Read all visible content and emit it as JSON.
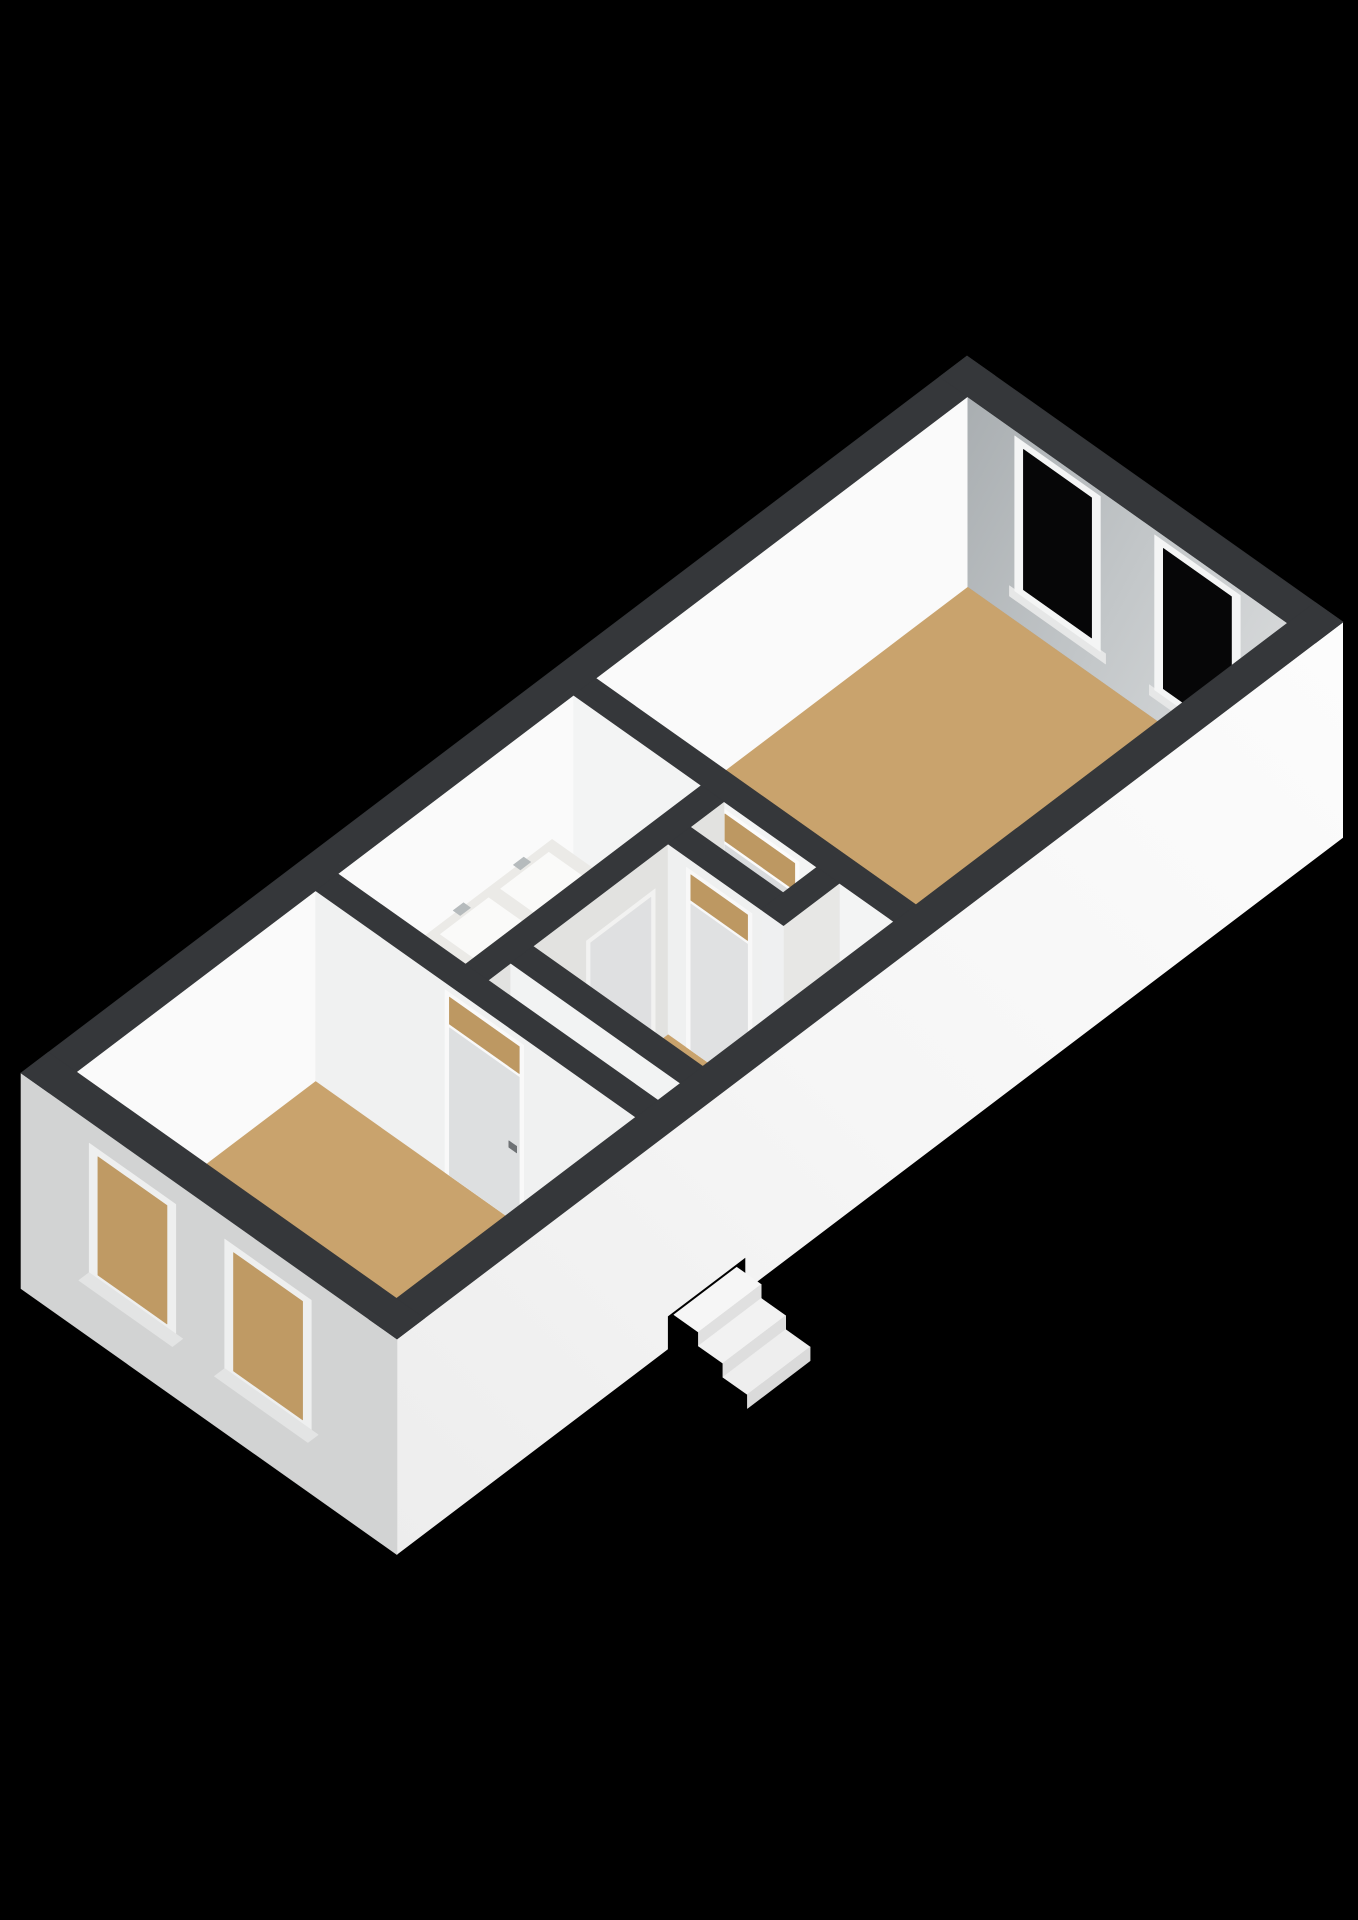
{
  "meta": {
    "kind": "3d-floorplan-render",
    "background": "#000000",
    "wall_top_color": "#35373a",
    "floor_color": "#c9a36d",
    "bathroom_floor_color": "#e9e8e5",
    "exterior_wall_color": "#f5f5f5",
    "glass_dark_color": "#060607",
    "glass_tan_color": "#bf9a64"
  },
  "scene": {
    "canvas": {
      "w": 1358,
      "h": 1920,
      "bg": "#000000"
    },
    "projection": {
      "origin": [
        21,
        1073
      ],
      "U": [
        86.0,
        -65.18
      ],
      "V": [
        87.44,
        61.86
      ],
      "zScale": 73.1,
      "wallTop": 2.6
    },
    "shapes": [
      {
        "name": "floor-bedroom",
        "t": "plan",
        "fill": "#c9a36d",
        "u1": 0.32,
        "v1": 0.32,
        "u2": 3.1,
        "v2": 3.98,
        "z": 0
      },
      {
        "name": "floor-bathroom",
        "t": "plan",
        "fill": "#e9e8e5",
        "u1": 3.36,
        "v1": 0.32,
        "u2": 6.1,
        "v2": 1.78,
        "z": 0
      },
      {
        "name": "floor-hall",
        "t": "plan",
        "fill": "#c9a36d",
        "u1": 3.36,
        "v1": 2.04,
        "u2": 6.1,
        "v2": 3.98,
        "z": 0
      },
      {
        "name": "floor-toilet",
        "t": "plan",
        "fill": "#edecea",
        "u1": 5.71,
        "v1": 2.04,
        "u2": 6.1,
        "v2": 3.1,
        "z": 0
      },
      {
        "name": "floor-living-room",
        "t": "plan",
        "fill": "#c9a36d",
        "u1": 6.36,
        "v1": 0.32,
        "u2": 10.68,
        "v2": 3.98,
        "z": 0
      },
      {
        "name": "wall-nw-interior-face",
        "t": "v",
        "fill": "#fafafa",
        "v": 0.32,
        "u1": 0.32,
        "u2": 10.68,
        "z1": 0,
        "z2": 2.6
      },
      {
        "name": "wall-ne-interior-face",
        "t": "u",
        "fill": "url(#gNE)",
        "u": 10.68,
        "v1": 0.32,
        "v2": 3.98,
        "z1": 0,
        "z2": 2.6
      },
      {
        "name": "window-ne-left-sill",
        "t": "u",
        "fill": "#e6e7e7",
        "u": 10.68,
        "v1": 0.8,
        "v2": 1.9,
        "z1": 0.28,
        "z2": 0.42
      },
      {
        "name": "window-ne-left-frame",
        "t": "u",
        "fill": "#f4f5f5",
        "u": 10.68,
        "v1": 0.86,
        "v2": 1.84,
        "z1": 0.4,
        "z2": 2.52
      },
      {
        "name": "window-ne-left-glass",
        "t": "u",
        "fill": "#060607",
        "u": 10.68,
        "v1": 0.96,
        "v2": 1.74,
        "z1": 0.5,
        "z2": 2.42
      },
      {
        "name": "window-ne-right-sill",
        "t": "u",
        "fill": "#e6e7e7",
        "u": 10.68,
        "v1": 2.4,
        "v2": 3.5,
        "z1": 0.28,
        "z2": 0.42
      },
      {
        "name": "window-ne-right-frame",
        "t": "u",
        "fill": "#f4f5f5",
        "u": 10.68,
        "v1": 2.46,
        "v2": 3.44,
        "z1": 0.4,
        "z2": 2.52
      },
      {
        "name": "window-ne-right-glass",
        "t": "u",
        "fill": "#060607",
        "u": 10.68,
        "v1": 2.56,
        "v2": 3.34,
        "z1": 0.5,
        "z2": 2.42
      },
      {
        "name": "wall-living-face",
        "t": "u",
        "fill": "#f3f4f4",
        "u": 6.1,
        "v1": 0.32,
        "v2": 3.98,
        "z1": 0,
        "z2": 2.6
      },
      {
        "name": "door-living-frame",
        "t": "u",
        "fill": "#fbfbfb",
        "u": 6.1,
        "v1": 2.0,
        "v2": 2.9,
        "z1": 0,
        "z2": 2.5
      },
      {
        "name": "door-living-leaf",
        "t": "u",
        "fill": "#d9dbdd",
        "u": 6.1,
        "v1": 2.05,
        "v2": 2.85,
        "z1": 0,
        "z2": 2.02
      },
      {
        "name": "door-living-transom-glass",
        "t": "u",
        "fill": "#bd9862",
        "u": 6.1,
        "v1": 2.05,
        "v2": 2.85,
        "z1": 2.07,
        "z2": 2.44
      },
      {
        "name": "door-living-handle",
        "t": "u",
        "fill": "#787c7f",
        "u": 6.1,
        "v1": 2.12,
        "v2": 2.21,
        "z1": 0.96,
        "z2": 1.05
      },
      {
        "name": "vanity-side-panel",
        "t": "u",
        "fill": "#9c8b75",
        "u": 4.35,
        "v1": 0.32,
        "v2": 0.9,
        "z1": 0,
        "z2": 0.85
      },
      {
        "name": "vanity-front-panel",
        "t": "v",
        "fill": "#857663",
        "v": 0.9,
        "u1": 4.35,
        "u2": 5.85,
        "z1": 0,
        "z2": 0.85
      },
      {
        "name": "vanity-countertop",
        "t": "plan",
        "fill": "#ebeae7",
        "u1": 4.35,
        "v1": 0.32,
        "u2": 5.85,
        "v2": 0.9,
        "z": 0.85
      },
      {
        "name": "vanity-sink-left",
        "t": "plan",
        "fill": "#fafaf9",
        "u1": 4.47,
        "v1": 0.4,
        "u2": 5.03,
        "v2": 0.82,
        "z": 0.85
      },
      {
        "name": "vanity-sink-right",
        "t": "plan",
        "fill": "#fafaf9",
        "u1": 5.17,
        "v1": 0.4,
        "u2": 5.73,
        "v2": 0.82,
        "z": 0.85
      },
      {
        "name": "vanity-faucet-left",
        "t": "plan",
        "fill": "#b6bbbd",
        "u1": 4.69,
        "v1": 0.33,
        "u2": 4.81,
        "v2": 0.41,
        "z": 0.92
      },
      {
        "name": "vanity-faucet-right",
        "t": "plan",
        "fill": "#b6bbbd",
        "u1": 5.39,
        "v1": 0.33,
        "u2": 5.51,
        "v2": 0.41,
        "z": 0.92
      },
      {
        "name": "wall-bathroom-face",
        "t": "v",
        "fill": "#e2e2e0",
        "v": 2.04,
        "u1": 3.36,
        "u2": 6.1,
        "z1": 0,
        "z2": 2.6
      },
      {
        "name": "door-bathroom-frame",
        "t": "v",
        "fill": "#f2f2f1",
        "v": 2.04,
        "u1": 4.5,
        "u2": 5.3,
        "z1": 0,
        "z2": 2.12
      },
      {
        "name": "door-bathroom-leaf",
        "t": "v",
        "fill": "#dfe0e1",
        "v": 2.04,
        "u1": 4.55,
        "u2": 5.25,
        "z1": 0,
        "z2": 2.05
      },
      {
        "name": "door-bathroom-handle",
        "t": "v",
        "fill": "#7b7f82",
        "v": 2.04,
        "u1": 4.62,
        "u2": 4.71,
        "z1": 0.97,
        "z2": 1.06
      },
      {
        "name": "wall-toilet-face",
        "t": "u",
        "fill": "#eff0f0",
        "u": 5.45,
        "v1": 2.04,
        "v2": 3.1,
        "z1": 0,
        "z2": 2.6
      },
      {
        "name": "wall-toilet-end-cap",
        "t": "v",
        "fill": "#e5e5e3",
        "v": 3.1,
        "u1": 5.45,
        "u2": 5.71,
        "z1": 0,
        "z2": 2.6
      },
      {
        "name": "door-toilet-frame",
        "t": "u",
        "fill": "#f8f8f8",
        "u": 5.45,
        "v1": 2.25,
        "v2": 3.0,
        "z1": 0,
        "z2": 2.46
      },
      {
        "name": "door-toilet-leaf",
        "t": "u",
        "fill": "#e0e1e2",
        "u": 5.45,
        "v1": 2.3,
        "v2": 2.95,
        "z1": 0,
        "z2": 2.0
      },
      {
        "name": "door-toilet-transom-glass",
        "t": "u",
        "fill": "#bd9862",
        "u": 5.45,
        "v1": 2.3,
        "v2": 2.95,
        "z1": 2.05,
        "z2": 2.4
      },
      {
        "name": "wall-toilet-se-face",
        "t": "v",
        "fill": "#e7e7e5",
        "v": 3.36,
        "u1": 5.45,
        "u2": 6.1,
        "z1": 0,
        "z2": 2.6
      },
      {
        "name": "wall-toilet-se-cap",
        "t": "u",
        "fill": "#eff0f1",
        "u": 5.45,
        "v1": 3.1,
        "v2": 3.36,
        "z1": 0,
        "z2": 2.6
      },
      {
        "name": "wall-vestibule-face",
        "t": "u",
        "fill": "#f2f3f3",
        "u": 3.62,
        "v1": 2.04,
        "v2": 3.98,
        "z1": 0,
        "z2": 2.6
      },
      {
        "name": "door-vestibule-frame",
        "t": "u",
        "fill": "#fafafa",
        "u": 3.62,
        "v1": 2.4,
        "v2": 3.25,
        "z1": 0,
        "z2": 2.12
      },
      {
        "name": "door-vestibule-leaf",
        "t": "u",
        "fill": "#e7e8e9",
        "u": 3.62,
        "v1": 2.45,
        "v2": 3.2,
        "z1": 0,
        "z2": 2.05
      },
      {
        "name": "door-vestibule-handle",
        "t": "u",
        "fill": "#75797c",
        "u": 3.62,
        "v1": 2.52,
        "v2": 2.61,
        "z1": 0.97,
        "z2": 1.06
      },
      {
        "name": "wall-bedroom-face",
        "t": "u",
        "fill": "#f0f1f1",
        "u": 3.1,
        "v1": 0.32,
        "v2": 3.98,
        "z1": 0,
        "z2": 2.6
      },
      {
        "name": "door-bedroom-frame",
        "t": "u",
        "fill": "#f9f9f9",
        "u": 3.1,
        "v1": 1.8,
        "v2": 2.7,
        "z1": 0,
        "z2": 2.5
      },
      {
        "name": "door-bedroom-leaf",
        "t": "u",
        "fill": "#dddfe0",
        "u": 3.1,
        "v1": 1.85,
        "v2": 2.65,
        "z1": 0,
        "z2": 2.02
      },
      {
        "name": "door-bedroom-transom-glass",
        "t": "u",
        "fill": "#bd9862",
        "u": 3.1,
        "v1": 1.85,
        "v2": 2.65,
        "z1": 2.07,
        "z2": 2.44
      },
      {
        "name": "door-bedroom-handle",
        "t": "u",
        "fill": "#6e7275",
        "u": 3.1,
        "v1": 2.53,
        "v2": 2.62,
        "z1": 0.96,
        "z2": 1.05
      },
      {
        "name": "wall-se-exterior-face",
        "t": "poly",
        "fill": "url(#gSE)",
        "pts": [
          [
            0,
            4.3,
            2.6
          ],
          [
            11,
            4.3,
            2.6
          ],
          [
            11,
            4.3,
            -0.35
          ],
          [
            4.05,
            4.3,
            -0.35
          ],
          [
            4.05,
            4.3,
            0.1
          ],
          [
            3.15,
            4.3,
            0.1
          ],
          [
            3.15,
            4.3,
            -0.35
          ],
          [
            0,
            4.3,
            -0.35
          ]
        ]
      },
      {
        "name": "wall-sw-exterior-face",
        "t": "u",
        "fill": "#d2d3d3",
        "u": 0,
        "v1": 0,
        "v2": 4.3,
        "z1": -0.35,
        "z2": 2.6
      },
      {
        "name": "window-sw-left-frame",
        "t": "u",
        "fill": "#eeefef",
        "u": 0,
        "v1": 0.78,
        "v2": 1.77,
        "z1": 0.48,
        "z2": 2.3
      },
      {
        "name": "window-sw-left-glass",
        "t": "u",
        "fill": "#bf9a64",
        "u": 0,
        "v1": 0.88,
        "v2": 1.67,
        "z1": 0.58,
        "z2": 2.2
      },
      {
        "name": "window-sw-left-sill",
        "t": "plan",
        "fill": "#e3e4e4",
        "u1": -0.08,
        "v1": 0.74,
        "u2": 0.04,
        "v2": 1.81,
        "z": 0.46
      },
      {
        "name": "window-sw-right-frame",
        "t": "u",
        "fill": "#eeefef",
        "u": 0,
        "v1": 2.33,
        "v2": 3.32,
        "z1": 0.48,
        "z2": 2.3
      },
      {
        "name": "window-sw-right-glass",
        "t": "u",
        "fill": "#bf9a64",
        "u": 0,
        "v1": 2.43,
        "v2": 3.22,
        "z1": 0.58,
        "z2": 2.2
      },
      {
        "name": "window-sw-right-sill",
        "t": "plan",
        "fill": "#e3e4e4",
        "u1": -0.08,
        "v1": 2.29,
        "u2": 0.04,
        "v2": 3.36,
        "z": 0.46
      },
      {
        "name": "wall-top-nw",
        "t": "plan",
        "fill": "#35373a",
        "u1": 0,
        "v1": 0,
        "u2": 11,
        "v2": 0.32,
        "z": 2.6
      },
      {
        "name": "wall-top-ne",
        "t": "plan",
        "fill": "#35373a",
        "u1": 10.68,
        "v1": 0,
        "u2": 11,
        "v2": 4.3,
        "z": 2.6
      },
      {
        "name": "wall-top-se",
        "t": "plan",
        "fill": "#35373a",
        "u1": 0,
        "v1": 3.98,
        "u2": 11,
        "v2": 4.3,
        "z": 2.6
      },
      {
        "name": "wall-top-sw",
        "t": "plan",
        "fill": "#35373a",
        "u1": 0,
        "v1": 0,
        "u2": 0.32,
        "v2": 4.3,
        "z": 2.6
      },
      {
        "name": "wall-top-bedroom-partition",
        "t": "plan",
        "fill": "#35373a",
        "u1": 3.1,
        "v1": 0.32,
        "u2": 3.36,
        "v2": 3.98,
        "z": 2.6
      },
      {
        "name": "wall-top-living-partition",
        "t": "plan",
        "fill": "#35373a",
        "u1": 6.1,
        "v1": 0.32,
        "u2": 6.36,
        "v2": 3.98,
        "z": 2.6
      },
      {
        "name": "wall-top-bathroom-partition",
        "t": "plan",
        "fill": "#35373a",
        "u1": 3.36,
        "v1": 1.78,
        "u2": 6.1,
        "v2": 2.04,
        "z": 2.6
      },
      {
        "name": "wall-top-vestibule-partition",
        "t": "plan",
        "fill": "#35373a",
        "u1": 3.62,
        "v1": 2.04,
        "u2": 3.88,
        "v2": 3.98,
        "z": 2.6
      },
      {
        "name": "wall-top-toilet-sw",
        "t": "plan",
        "fill": "#35373a",
        "u1": 5.45,
        "v1": 2.04,
        "u2": 5.71,
        "v2": 3.1,
        "z": 2.6
      },
      {
        "name": "wall-top-toilet-se",
        "t": "plan",
        "fill": "#35373a",
        "u1": 5.45,
        "v1": 3.1,
        "u2": 6.1,
        "v2": 3.36,
        "z": 2.6
      },
      {
        "name": "entry-step-1-tread",
        "t": "plan",
        "fill": "#f6f6f6",
        "u1": 3.22,
        "v1": 4.3,
        "u2": 3.95,
        "v2": 4.58,
        "z": 0.06
      },
      {
        "name": "entry-step-1-riser",
        "t": "v",
        "fill": "#e0e0e0",
        "v": 4.58,
        "u1": 3.22,
        "u2": 3.95,
        "z1": -0.13,
        "z2": 0.06
      },
      {
        "name": "entry-step-2-tread",
        "t": "plan",
        "fill": "#f2f2f2",
        "u1": 3.22,
        "v1": 4.58,
        "u2": 3.95,
        "v2": 4.86,
        "z": -0.13
      },
      {
        "name": "entry-step-2-riser",
        "t": "v",
        "fill": "#dedede",
        "v": 4.86,
        "u1": 3.22,
        "u2": 3.95,
        "z1": -0.32,
        "z2": -0.13
      },
      {
        "name": "entry-step-3-tread",
        "t": "plan",
        "fill": "#eeeeee",
        "u1": 3.22,
        "v1": 4.86,
        "u2": 3.95,
        "v2": 5.14,
        "z": -0.32
      },
      {
        "name": "entry-step-3-riser",
        "t": "v",
        "fill": "#dadada",
        "v": 5.14,
        "u1": 3.22,
        "u2": 3.95,
        "z1": -0.51,
        "z2": -0.32
      }
    ]
  }
}
